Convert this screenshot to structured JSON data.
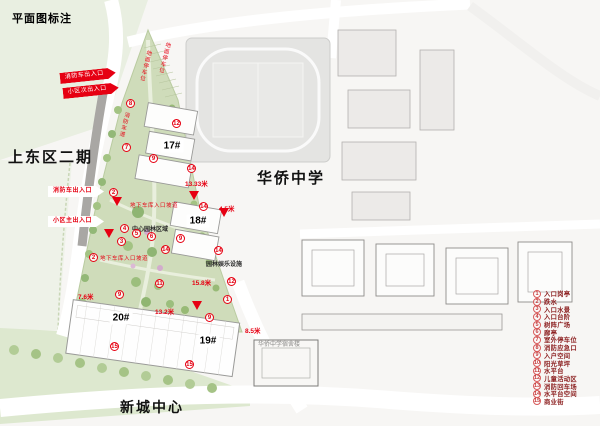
{
  "title": "平面图标注",
  "colors": {
    "annotation_red": "#e60012",
    "legend_text": "#8b1e1e",
    "site_green": "#cfdcba"
  },
  "area_labels": {
    "phase2": "上东区二期",
    "school": "华侨中学",
    "center": "新城中心",
    "dormitory": "华侨中学宿舍楼"
  },
  "buildings": {
    "b17": "17#",
    "b18": "18#",
    "b19": "19#",
    "b20": "20#"
  },
  "entrance_arrows": {
    "fire_top": "消防车出入口",
    "secondary": "小区次出入口",
    "fire_mid": "消防车出入口",
    "main": "小区主出入口"
  },
  "red_notes": {
    "ground_parking_1": "地面停车位",
    "ground_parking_2": "地面停车位",
    "fire_lane": "消防车道",
    "garage_ramp_1": "地下车库入口坡道",
    "garage_ramp_2": "地下车库入口坡道"
  },
  "dimensions": {
    "d1": "13.33米",
    "d2": "4.5米",
    "d3": "15.8米",
    "d4": "13.2米",
    "d5": "7.6米",
    "d6": "8.5米"
  },
  "site_notes": {
    "central_garden": "中心园林区域",
    "amenities": "园林娱乐设施"
  },
  "plan_markers": [
    {
      "n": "8",
      "x": 131,
      "y": 104
    },
    {
      "n": "7",
      "x": 127,
      "y": 148
    },
    {
      "n": "12",
      "x": 177,
      "y": 124
    },
    {
      "n": "9",
      "x": 154,
      "y": 159
    },
    {
      "n": "14",
      "x": 192,
      "y": 169
    },
    {
      "n": "14",
      "x": 204,
      "y": 207
    },
    {
      "n": "9",
      "x": 181,
      "y": 239
    },
    {
      "n": "14",
      "x": 166,
      "y": 250
    },
    {
      "n": "14",
      "x": 219,
      "y": 251
    },
    {
      "n": "2",
      "x": 114,
      "y": 193
    },
    {
      "n": "4",
      "x": 125,
      "y": 229
    },
    {
      "n": "5",
      "x": 137,
      "y": 234
    },
    {
      "n": "6",
      "x": 152,
      "y": 237
    },
    {
      "n": "3",
      "x": 122,
      "y": 242
    },
    {
      "n": "2",
      "x": 94,
      "y": 258
    },
    {
      "n": "12",
      "x": 232,
      "y": 282
    },
    {
      "n": "11",
      "x": 160,
      "y": 284
    },
    {
      "n": "1",
      "x": 228,
      "y": 300
    },
    {
      "n": "9",
      "x": 120,
      "y": 295
    },
    {
      "n": "9",
      "x": 210,
      "y": 318
    },
    {
      "n": "15",
      "x": 115,
      "y": 347
    },
    {
      "n": "15",
      "x": 190,
      "y": 365
    }
  ],
  "legend": {
    "items": [
      {
        "n": "1",
        "label": "入口岗亭"
      },
      {
        "n": "2",
        "label": "跌水"
      },
      {
        "n": "3",
        "label": "入口水景"
      },
      {
        "n": "4",
        "label": "入口台阶"
      },
      {
        "n": "5",
        "label": "树阵广场"
      },
      {
        "n": "6",
        "label": "廊亭"
      },
      {
        "n": "7",
        "label": "室外停车位"
      },
      {
        "n": "8",
        "label": "消防应急口"
      },
      {
        "n": "9",
        "label": "入户空间"
      },
      {
        "n": "10",
        "label": "阳光草坪"
      },
      {
        "n": "11",
        "label": "水平台"
      },
      {
        "n": "12",
        "label": "儿童活动区"
      },
      {
        "n": "13",
        "label": "消防回车场"
      },
      {
        "n": "14",
        "label": "水平台空间"
      },
      {
        "n": "15",
        "label": "商业街"
      }
    ]
  }
}
